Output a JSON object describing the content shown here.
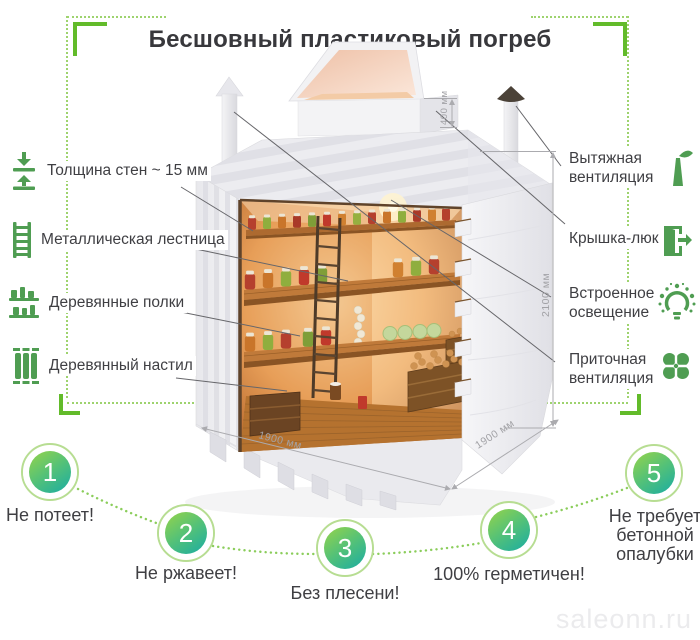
{
  "header": {
    "title": "Бесшовный пластиковый погреб"
  },
  "watermark": "saleonn.ru",
  "features_left": [
    {
      "label": "Толщина стен ~ 15 мм",
      "icon": "wall-thickness-icon"
    },
    {
      "label": "Металлическая лестница",
      "icon": "ladder-icon"
    },
    {
      "label": "Деревянные полки",
      "icon": "wooden-shelves-icon"
    },
    {
      "label": "Деревянный настил",
      "icon": "wooden-planks-icon"
    }
  ],
  "features_right": [
    {
      "label": "Вытяжная вентиляция",
      "icon": "exhaust-vent-icon"
    },
    {
      "label": "Крышка-люк",
      "icon": "hatch-lid-icon"
    },
    {
      "label": "Встроенное освещение",
      "icon": "light-bulb-icon"
    },
    {
      "label": "Приточная вентиляция",
      "icon": "supply-fan-icon"
    }
  ],
  "dimensions": {
    "hatch_height": "400 мм",
    "cellar_height": "2100 мм",
    "cellar_width": "1900 мм",
    "cellar_depth": "1900 мм"
  },
  "benefits": [
    {
      "number": "1",
      "label": "Не потеет!"
    },
    {
      "number": "2",
      "label": "Не ржавеет!"
    },
    {
      "number": "3",
      "label": "Без плесени!"
    },
    {
      "number": "4",
      "label": "100% герметичен!"
    },
    {
      "number": "5",
      "label": "Не требует бетонной опалубки"
    }
  ],
  "colors": {
    "accent_green": "#62bb2a",
    "dotted_green": "#9ed36e",
    "icon_green": "#4f9d52",
    "text_dark": "#3f3f43",
    "circle_gradient_top": "#90d24e",
    "circle_gradient_bottom": "#1fae9f",
    "dimension_gray": "#a2a2a6"
  }
}
